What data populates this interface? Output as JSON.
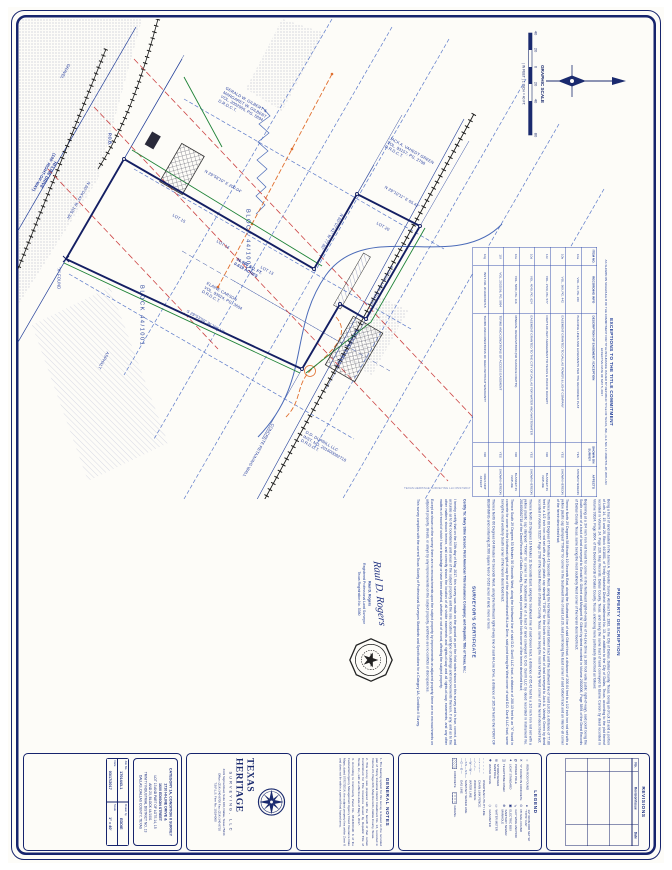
{
  "colors": {
    "ink": "#1d2f80",
    "boundary": "#141f63",
    "fence_green": "#1d8236",
    "easement_red": "#cc4444",
    "overhead_orange": "#e07030",
    "utility_blue": "#5b79c9"
  },
  "scale_bar": {
    "title": "GRAPHIC SCALE",
    "ticks": [
      "40",
      "20",
      "0",
      "20",
      "40",
      "80"
    ],
    "caption": "( IN FEET )  1 INCH = 40 FT."
  },
  "plot_stamp": "TEXAS HERITAGE SURVEYING LLC   05/17/2017",
  "drawing": {
    "labels": {
      "bearing_a": "N 29°58'10\" E   200.04'",
      "bearing_b": "N 60°07'41\" W   77.80'",
      "bearing_c": "N 29°10'11\" E   65.42'",
      "bearing_d": "S 29°53'50\" W   200.13'",
      "bearing_e": "N 60°04'43\" W   105.34'",
      "street_hiline": "HI-LINE DRIVE\n(100' RIGHT-OF-WAY)",
      "street_edison": "EDISON STREET",
      "owner_gilbert": "GERALD W. GILBERT &\nMARGARET W. GILBERT\nVOL. 2002006, PG. 5894\nD.R.D.C.T.",
      "owner_green": "JACK A. VAHEDY GREEN\nVOL. 93157, PG. 2708\nD.R.D.C.T.",
      "owner_durrill": "D.D. DURRILL LLC\nINST. NO. 201600082718\nD.R.D.C.T.",
      "owner_subject": "ELAINE CARSON\nVOL. 93024, PG. 3604\nD.R.D.C.T.",
      "block_1": "BLOCK 44/1001",
      "block_2": "BLOCK 44/1001",
      "area": "26,960 SQ. FT.\n0.619 ACRES",
      "pob": "P.O.B.",
      "xfnd": "\"X\" FOUND",
      "lot13": "LOT 13",
      "lot14": "LOT 14",
      "lot15": "LOT 15",
      "lot20": "LOT 20",
      "gravel": "GRAVEL",
      "asphalt": "ASPHALT",
      "wall": "CONCRETE RETAINING WALL",
      "fence": "8' CHAIN LINK FENCE"
    }
  },
  "exceptions": {
    "title": "EXCEPTIONS TO THE TITLE COMMITMENT",
    "subtitle": "AS SHOWN ON SCHEDULE B OF THE COMMITMENT FOR TITLE INSURANCE ISSUED BY REPUBLIC TITLE OF TEXAS, INC., G.F. NO. 17-18007871-RT, WITH AN EFFECTIVE DATE OF MAY 5, 2017",
    "headers": [
      "ITEM NO.",
      "RECORDING INFO",
      "DESCRIPTION OF EASEMENT / EXCEPTION",
      "SHOWN ON SURVEY",
      "AFFECTS"
    ],
    "rows": [
      [
        "10a",
        "VOL. 24, PG. 220",
        "BUILDING LINES AND EASEMENTS PER THE RECORDED PLAT",
        "YES",
        "SHOWN HEREON"
      ],
      [
        "10b",
        "VOL. 369, PG. 442",
        "EASEMENT GRANTED TO DALLAS POWER & LIGHT COMPANY",
        "YES",
        "SHOWN HEREON"
      ],
      [
        "10c",
        "VOL. 2729, PG. 577",
        "RIGHT-OF-WAY AGREEMENT TO TEXAS & PACIFIC RAILWAY",
        "NO",
        "BLANKET IN NATURE"
      ],
      [
        "10d",
        "VOL. 4049, PG. 624",
        "EASEMENT GRANTED TO THE CITY OF DALLAS FOR WATER AND WASTEWATER",
        "YES",
        "SHOWN HEREON"
      ],
      [
        "10e",
        "VOL. 5280, PG. 116",
        "MINERAL RESERVATION (NO SURFACE RIGHTS)",
        "NO",
        "BLANKET IN NATURE"
      ],
      [
        "10f",
        "VOL. 2002006, PG. 5894",
        "TERMS AND CONDITIONS OF ACCESS EASEMENT",
        "YES",
        "SHOWN HEREON"
      ],
      [
        "10g",
        "INST. NO. 201600082718",
        "TERMS AND CONDITIONS OF DEED WITHOUT WARRANTY",
        "NO",
        "DOES NOT AFFECT"
      ]
    ]
  },
  "property_description": {
    "title": "PROPERTY DESCRIPTION",
    "paragraphs": [
      "Being a tract of land situated in the James A. Sylvester Survey, Abstract No. 1383, in the City of Dallas, Dallas County, Texas, being all of Lot 13 and a portion of Lots 14, 15 and 20, Block 44/1001, of Trinity Industrial District Installment No. 13, an addition to the City of Dallas, Texas, according to the plat thereof recorded in Volume 24, Page 220, Map Records, Dallas County, Texas, and being the same tract of land conveyed to Elaine Carson by deed recorded in Volume 93024, Page 3604, of the Deed Records of Dallas County, Texas, and being more particularly described as follows:",
      "Beginning at a 3/4 inch iron rod found for corner in the Northeast right-of-way line of Hi-Line Drive (a 100 foot wide public right-of-way), said point being the South corner of a tract of land conveyed to Gerald W. Gilbert and Margaret W. Gilbert by deed recorded in Volume 2002006, Page 5894 of the Deed Records of Dallas County, Texas, same being the most southerly West corner of the herein described tract;",
      "Thence North 29 Degrees 58 Minutes 10 Seconds East, along the Southeast line of said Gilbert tract, a distance of 200.04 feet to a 1/2 inch iron rod set with a yellow plastic cap stamped \"TXHS\" for corner in the Southwest line of said Lot 20, said point being the East corner of said Gilbert tract and an interior ell corner of the herein described tract;",
      "Thence North 60 Degrees 07 Minutes 41 Seconds West, along the Northeast line of said Gilbert tract and the Southwest line of said Lot 20, a distance of 77.80 feet to a 1/2 inch iron rod set with a yellow plastic cap stamped \"TXHS\" for the North corner of a tract of land conveyed to Jack A. Vahedy Green by deed recorded in Volume 93157, Page 2708 of the Deed Records of Dallas County, Texas, same being the most northerly West corner of the herein described tract;",
      "Thence North 29 Degrees 10 Minutes 11 Seconds East, along the Southeast line of said Green tract, a distance of 65.42 feet to a 1/2 inch iron rod set with a yellow plastic cap stamped \"TXHS\" for corner in the Southwest line of a tract of land conveyed to D.D. Durrill LLC by deed recorded in Instrument No. 201600082718 of the Deed Records of Dallas County, Texas, said point being the North corner of the herein described tract;",
      "Thence South 29 Degrees 53 Minutes 50 Seconds West, along the Northwest line of said D.D. Durrill LLC tract, a distance of 200.13 feet to an \"X\" found in concrete for corner in the Northeast right-of-way line of the aforementioned Hi-Line Drive, said point being the West corner of said D.D. Durrill LLC tract, same being the most westerly South corner of the herein described tract;",
      "Thence North 60 Degrees 04 Minutes 43 Seconds West, along the Northeast right-of-way line of said Hi-Line Drive, a distance of 105.34 feet to the POINT OF BEGINNING and containing 26,960 square feet or 0.619 acres of land, more or less."
    ]
  },
  "certificate": {
    "title": "SURVEYOR'S CERTIFICATE",
    "certify_to": "Certify To: Mary Stine Carson; First American Title Insurance Company; and Republic Title of Texas, Inc.:",
    "paragraphs": [
      "I hereby certify that on the 13th day of May, 2017, this survey was made on the ground as per the field notes shown on this survey and is true, correct, and accurate as to the boundaries and areas of the subject property and the size, location, and type of buildings and improvements thereon, if any, and as to the other matters shown hereon, and correctly shows the location of all visible easements and rights-of-way and all rights-of-way, easements, and any other matters of record of which I have knowledge or have been advised, whether or not of record, affecting the subject property.",
      "Except as shown on the survey: there are no encroachments upon the subject property by improvements on adjacent property, there are no encroachments on adjacent property, streets, or alleys by any improvements on the subject property, and there are no conflicts or discrepancies.",
      "This survey complies with the current Texas Society of Professional Surveyors Standards and Specifications for a Category 1A, Condition II Survey."
    ],
    "signature_script": "Raul D. Rogers",
    "typed_name": "Raul D. Rogers",
    "typed_title": "Registered Professional Land Surveyor",
    "typed_number": "Texas Registration No. 5380"
  },
  "revisions": {
    "title": "REVISIONS",
    "headers": [
      "No.",
      "Revision/Issue",
      "Date"
    ]
  },
  "legend": {
    "title": "LEGEND",
    "points": [
      {
        "s": "○",
        "l": "IRON ROD FOUND"
      },
      {
        "s": "●",
        "l": "1/2\" IRON ROD SET W/ \"TXHS\" CAP"
      },
      {
        "s": "✕",
        "l": "\"X\" FOUND IN CONCRETE"
      },
      {
        "s": "⊙",
        "l": "PK NAIL FOUND"
      },
      {
        "s": "Ø",
        "l": "POWER POLE"
      },
      {
        "s": "⇘",
        "l": "GUY WIRE ANCHOR"
      },
      {
        "s": "✦",
        "l": "LIGHT STANDARD"
      },
      {
        "s": "▣",
        "l": "ELECTRIC BOX"
      },
      {
        "s": "◫",
        "l": "TELEPHONE RISER"
      },
      {
        "s": "⊕",
        "l": "SANITARY SEWER MANHOLE"
      },
      {
        "s": "◎",
        "l": "STORM SEWER MANHOLE"
      },
      {
        "s": "▭",
        "l": "WATER METER"
      },
      {
        "s": "✚",
        "l": "WATER VALVE"
      },
      {
        "s": "◇",
        "l": "GAS METER"
      }
    ],
    "lines": [
      {
        "s": "– – – – –",
        "l": "OVERHEAD UTILITY LINE"
      },
      {
        "s": "—×—×—",
        "l": "CHAIN LINK FENCE"
      },
      {
        "s": "—/—/—",
        "l": "WOOD FENCE"
      },
      {
        "s": "—W—W—",
        "l": "WATER LINE"
      },
      {
        "s": "—SS—SS—",
        "l": "SANITARY SEWER LINE"
      },
      {
        "s": "—G—G—",
        "l": "GAS LINE"
      }
    ],
    "concrete_label": "CONCRETE",
    "gravel_label": "GRAVEL"
  },
  "general_notes": {
    "title": "GENERAL NOTES",
    "notes": [
      "1. The bearing system for this survey is based on the recorded plat of Trinity Industrial District Installment No. 13, recorded in Volume 24, Page 220, Map Records, Dallas County, Texas.",
      "2. This survey was prepared with the benefit of that certain Commitment for Title Insurance issued by Republic Title of Texas, Inc., with an effective date of May 5, 2017.",
      "3. According to Community Panel No. 48113C0190 K of the Federal Emergency Management Agency Flood Insurance Rate Maps, dated 07/07/2014, the subject property lies within Zone X and does not lie within a special flood hazard area."
    ]
  },
  "brand": {
    "name_1": "TEXAS HERITAGE",
    "name_2": "SURVEYING, LLC",
    "address": "4333 Sigma Road, Suite 100, Dallas, Texas 75244",
    "phone": "Office: (214) 340-9700   Fax: (214) 340-9710",
    "firm": "T.B.P.L.S. Firm No. 10194060"
  },
  "project": {
    "category": "CATEGORY 1A, CONDITION II SURVEY",
    "addr1": "1710 HI-LINE DRIVE &",
    "addr2": "1600 EDISON STREET",
    "lot_line1": "LOT 13 AND PART OF LOTS 14, 15",
    "lot_line2": "AND 20, BLOCK 44/1001",
    "district": "TRINITY INDUSTRIAL DISTRICT NO. 13",
    "city": "DALLAS, DALLAS COUNTY, TEXAS",
    "fields": {
      "job_label": "Job No.",
      "job": "1701443-1",
      "drawn_label": "Drawn by",
      "drawn": "EDDIE",
      "date_label": "Date",
      "date": "03/17/2017",
      "scale_label": "Scale",
      "scale": "1\" = 40'"
    }
  }
}
